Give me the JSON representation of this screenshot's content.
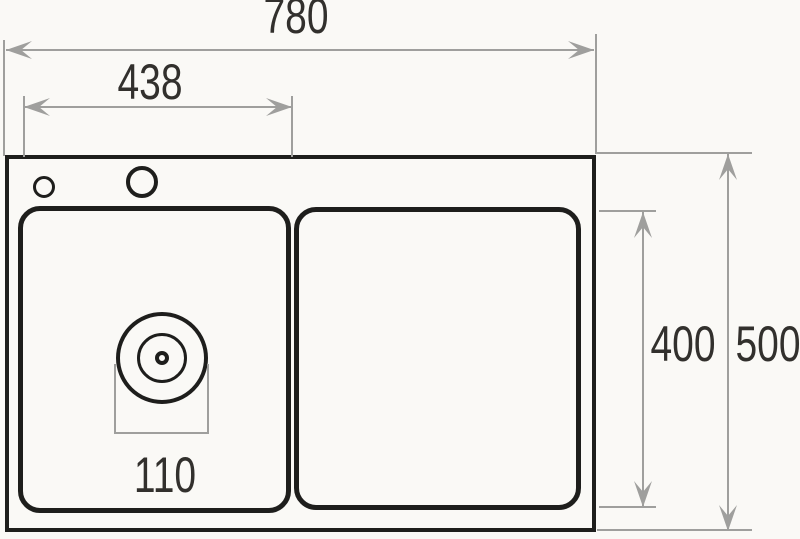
{
  "diagram": {
    "kind": "kitchen-sink-technical-dimension-drawing-top-view",
    "labels": {
      "overall_width": "780",
      "left_bowl_width": "438",
      "bowl_inner_height": "400",
      "overall_height": "500",
      "drain_diameter": "110"
    },
    "colors": {
      "outline": "#1e1e1c",
      "dimension": "#9f9f9d",
      "text": "#32302d",
      "background": "#faf9f6"
    }
  }
}
